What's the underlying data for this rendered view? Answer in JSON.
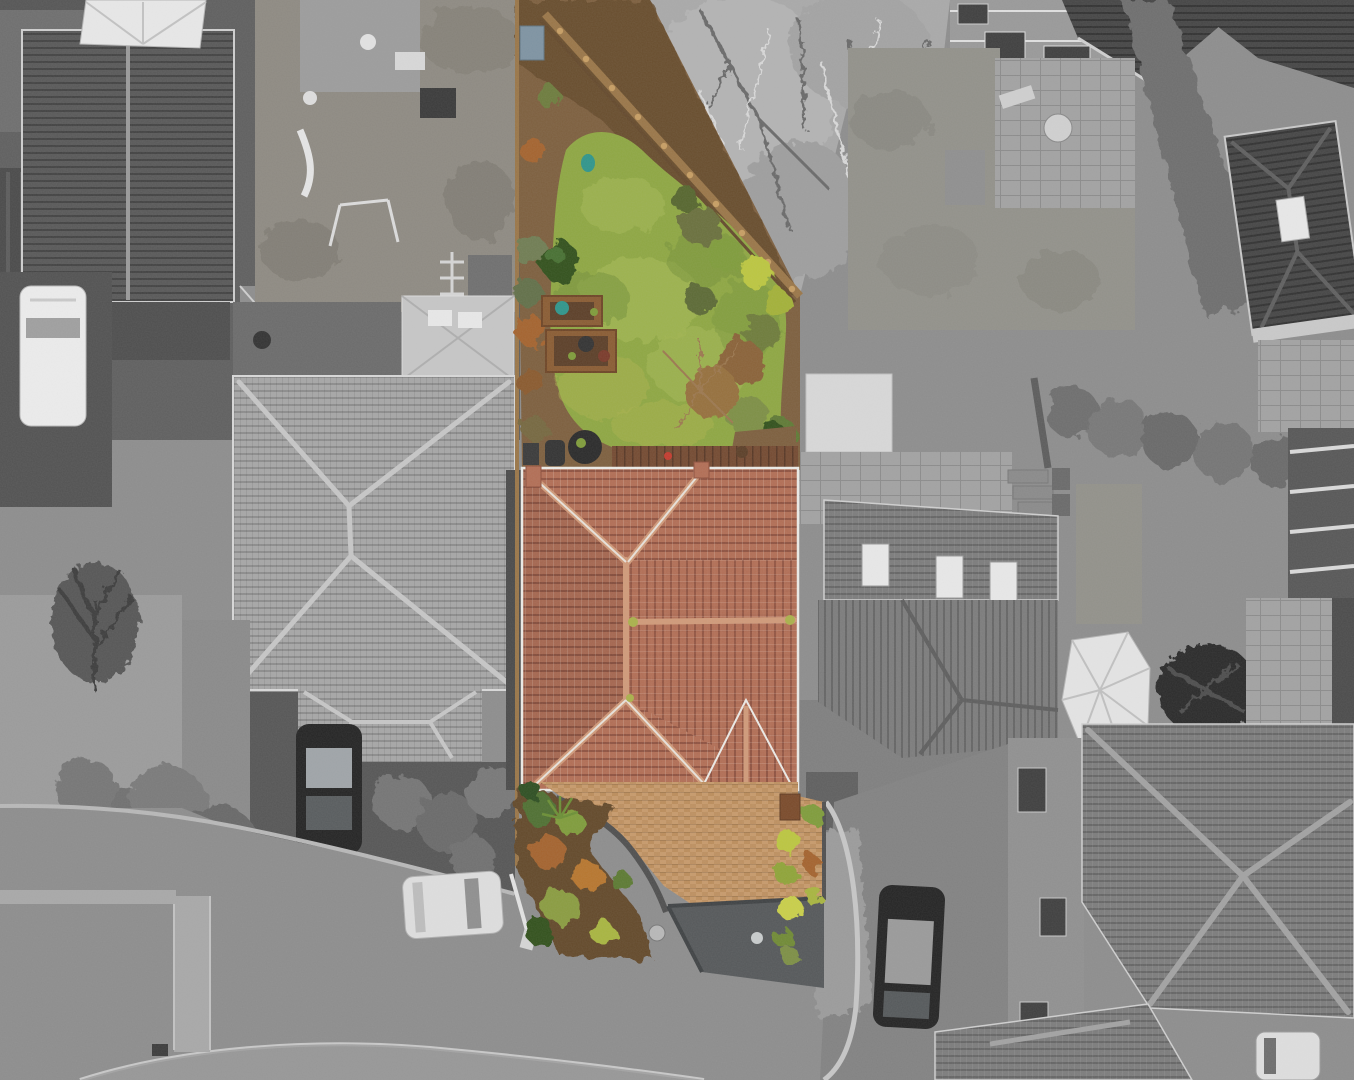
{
  "image": {
    "kind": "aerial-drone-photograph",
    "description": "Top-down aerial photograph of a residential close. The central listing property is shown in colour (terracotta tiled hip roof, green rear lawn with timber boundary fence, tan block-paved driveway with dark tarmac apron) while every surrounding house, garden, road and car is rendered in grayscale.",
    "width_px": 1354,
    "height_px": 1080
  },
  "highlighted_property": {
    "style": "selective-colour highlight",
    "roof": "terracotta tiled hip roof with K-shaped ridge lines, light mortar flashing and small front porch gable at lower right",
    "rear_garden": "mossy green lawn widening toward the house, timber fence on the diagonal rear boundary, soil borders with shrubs",
    "features": [
      "raised timber planter beds",
      "dark covered patio furniture",
      "brown decked strip by the house",
      "teal watering can on the lawn",
      "blue-grey storage box by top fence",
      "bright yellow-green shrubs beside the driveway",
      "timber side gate",
      "red item on the deck"
    ],
    "driveway": "tan herringbone block paving edged with dark soldier-course border and a dark grey tarmac apron triangle meeting the road"
  },
  "surroundings_grayscale": [
    "top-left detached house with dark gable roof and white conservatory",
    "children's play garden with slide, swing frame and trampoline",
    "white van parked on dark drive at far left",
    "large light-grey hip-roof bungalow left of the property with garage extension",
    "dark hatchback parked on left neighbour's drive",
    "bare winter tree and conifer shrubs on the verge",
    "curved grey cul-de-sac road with light kerbs, vertical footpath and street lamp",
    "white hatchback parked on the road below the property",
    "top-centre brick house with dark roof, patio and round garden table",
    "leafless overhanging trees above the rear boundary",
    "top-right dark hip-roof house with white roof window",
    "right-hand neighbour with flat-roof garage, stone patio, roof windows, white conservatory, pergola and covered object",
    "bottom-right pair of large grey hip roofs with crossing ridge lines",
    "dark saloon car with pale roof parked on bottom-right drive",
    "pale car entering at the bottom-right corner"
  ],
  "colors": {
    "road": "#8d8d8d",
    "roadDark": "#6f6f6f",
    "sidewalk": "#a8a8a8",
    "curb": "#c4c4c4",
    "gravel": "#9b9b9b",
    "grassGray": "#92918a",
    "hedgeGray": "#6e6e6e",
    "wallGray": "#909090",
    "windowDark": "#3f3f3f",
    "roofLight": "#a6a6a6",
    "roofLightRow": "#8c8c8c",
    "roofMid": "#7c7c7c",
    "roofMidRow": "#656565",
    "roofDark": "#585858",
    "roofDarkRow": "#424242",
    "roofDarkest": "#454545",
    "roofDarkestRow": "#313131",
    "whiteStruct": "#e8e8e8",
    "carDark": "#242424",
    "carLight": "#dedede",
    "vanWhite": "#ececec",
    "soil": "#7d5f3e",
    "soilDark": "#64492c",
    "fenceWood": "#9a7648",
    "fencePost": "#c79e63",
    "lawn": "#8ea742",
    "lawnLight": "#a2b651",
    "lawnDark": "#74903a",
    "mossYellow": "#aab14b",
    "bushDark": "#32511f",
    "bushGreen": "#7f9c3a",
    "bushYellow": "#bcc63f",
    "bushOrange": "#a4642f",
    "bedWood": "#8a5c33",
    "teal": "#2f958b",
    "blueBox": "#7e93a2",
    "redItem": "#c43b2e",
    "deck": "#744a31",
    "roofTerra": "#b26e55",
    "roofTerraRow": "#8f5240",
    "ridgeTerra": "#d09a79",
    "paveTan": "#c79a6b",
    "paveTanDark": "#b2834f",
    "paveBorder": "#4f4f4f",
    "apron": "#55585a",
    "gateBrown": "#7a4a2a"
  }
}
